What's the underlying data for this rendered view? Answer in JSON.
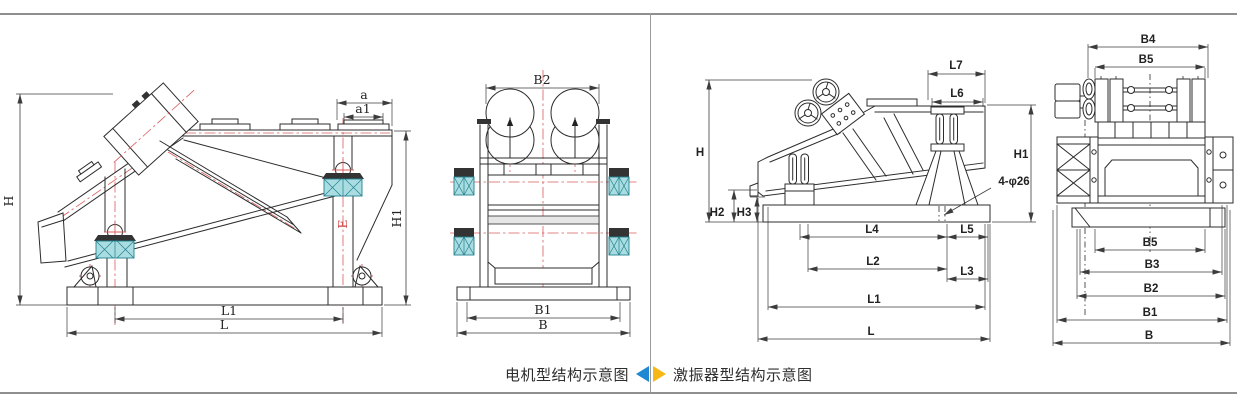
{
  "captions": {
    "motor": {
      "text": "电机型结构示意图",
      "arrow_color": "#1e88d2"
    },
    "exciter": {
      "text": "激振器型结构示意图",
      "arrow_color": "#f6b819"
    }
  },
  "colors": {
    "drawing_line": "#2c2c2c",
    "dimension_line": "#3c3c3c",
    "centerline_red": "#d95c5c",
    "spring_fill": "#a9dde2",
    "spring_stroke": "#22808e",
    "frame_border": "#8f8f8f",
    "blue_arrow": "#1e88d2",
    "yellow_arrow": "#f6b819"
  },
  "motor_side": {
    "labels": {
      "h": "H",
      "a": "a",
      "a1": "a1",
      "h1": "H1",
      "e": "E",
      "l1": "L1",
      "l": "L"
    }
  },
  "motor_front": {
    "labels": {
      "b2": "B2",
      "b1": "B1",
      "b": "B"
    }
  },
  "exciter_side": {
    "labels": {
      "l7": "L7",
      "l6": "L6",
      "h": "H",
      "h1": "H1",
      "h2": "H2",
      "h3": "H3",
      "bolt_note": "4-φ26",
      "l4": "L4",
      "l5": "L5",
      "l2": "L2",
      "l3": "L3",
      "l1": "L1",
      "l": "L"
    }
  },
  "exciter_front": {
    "labels": {
      "b4": "B4",
      "b5_top": "B5",
      "b5": "B5",
      "b3": "B3",
      "b2": "B2",
      "b1": "B1",
      "b": "B"
    }
  }
}
